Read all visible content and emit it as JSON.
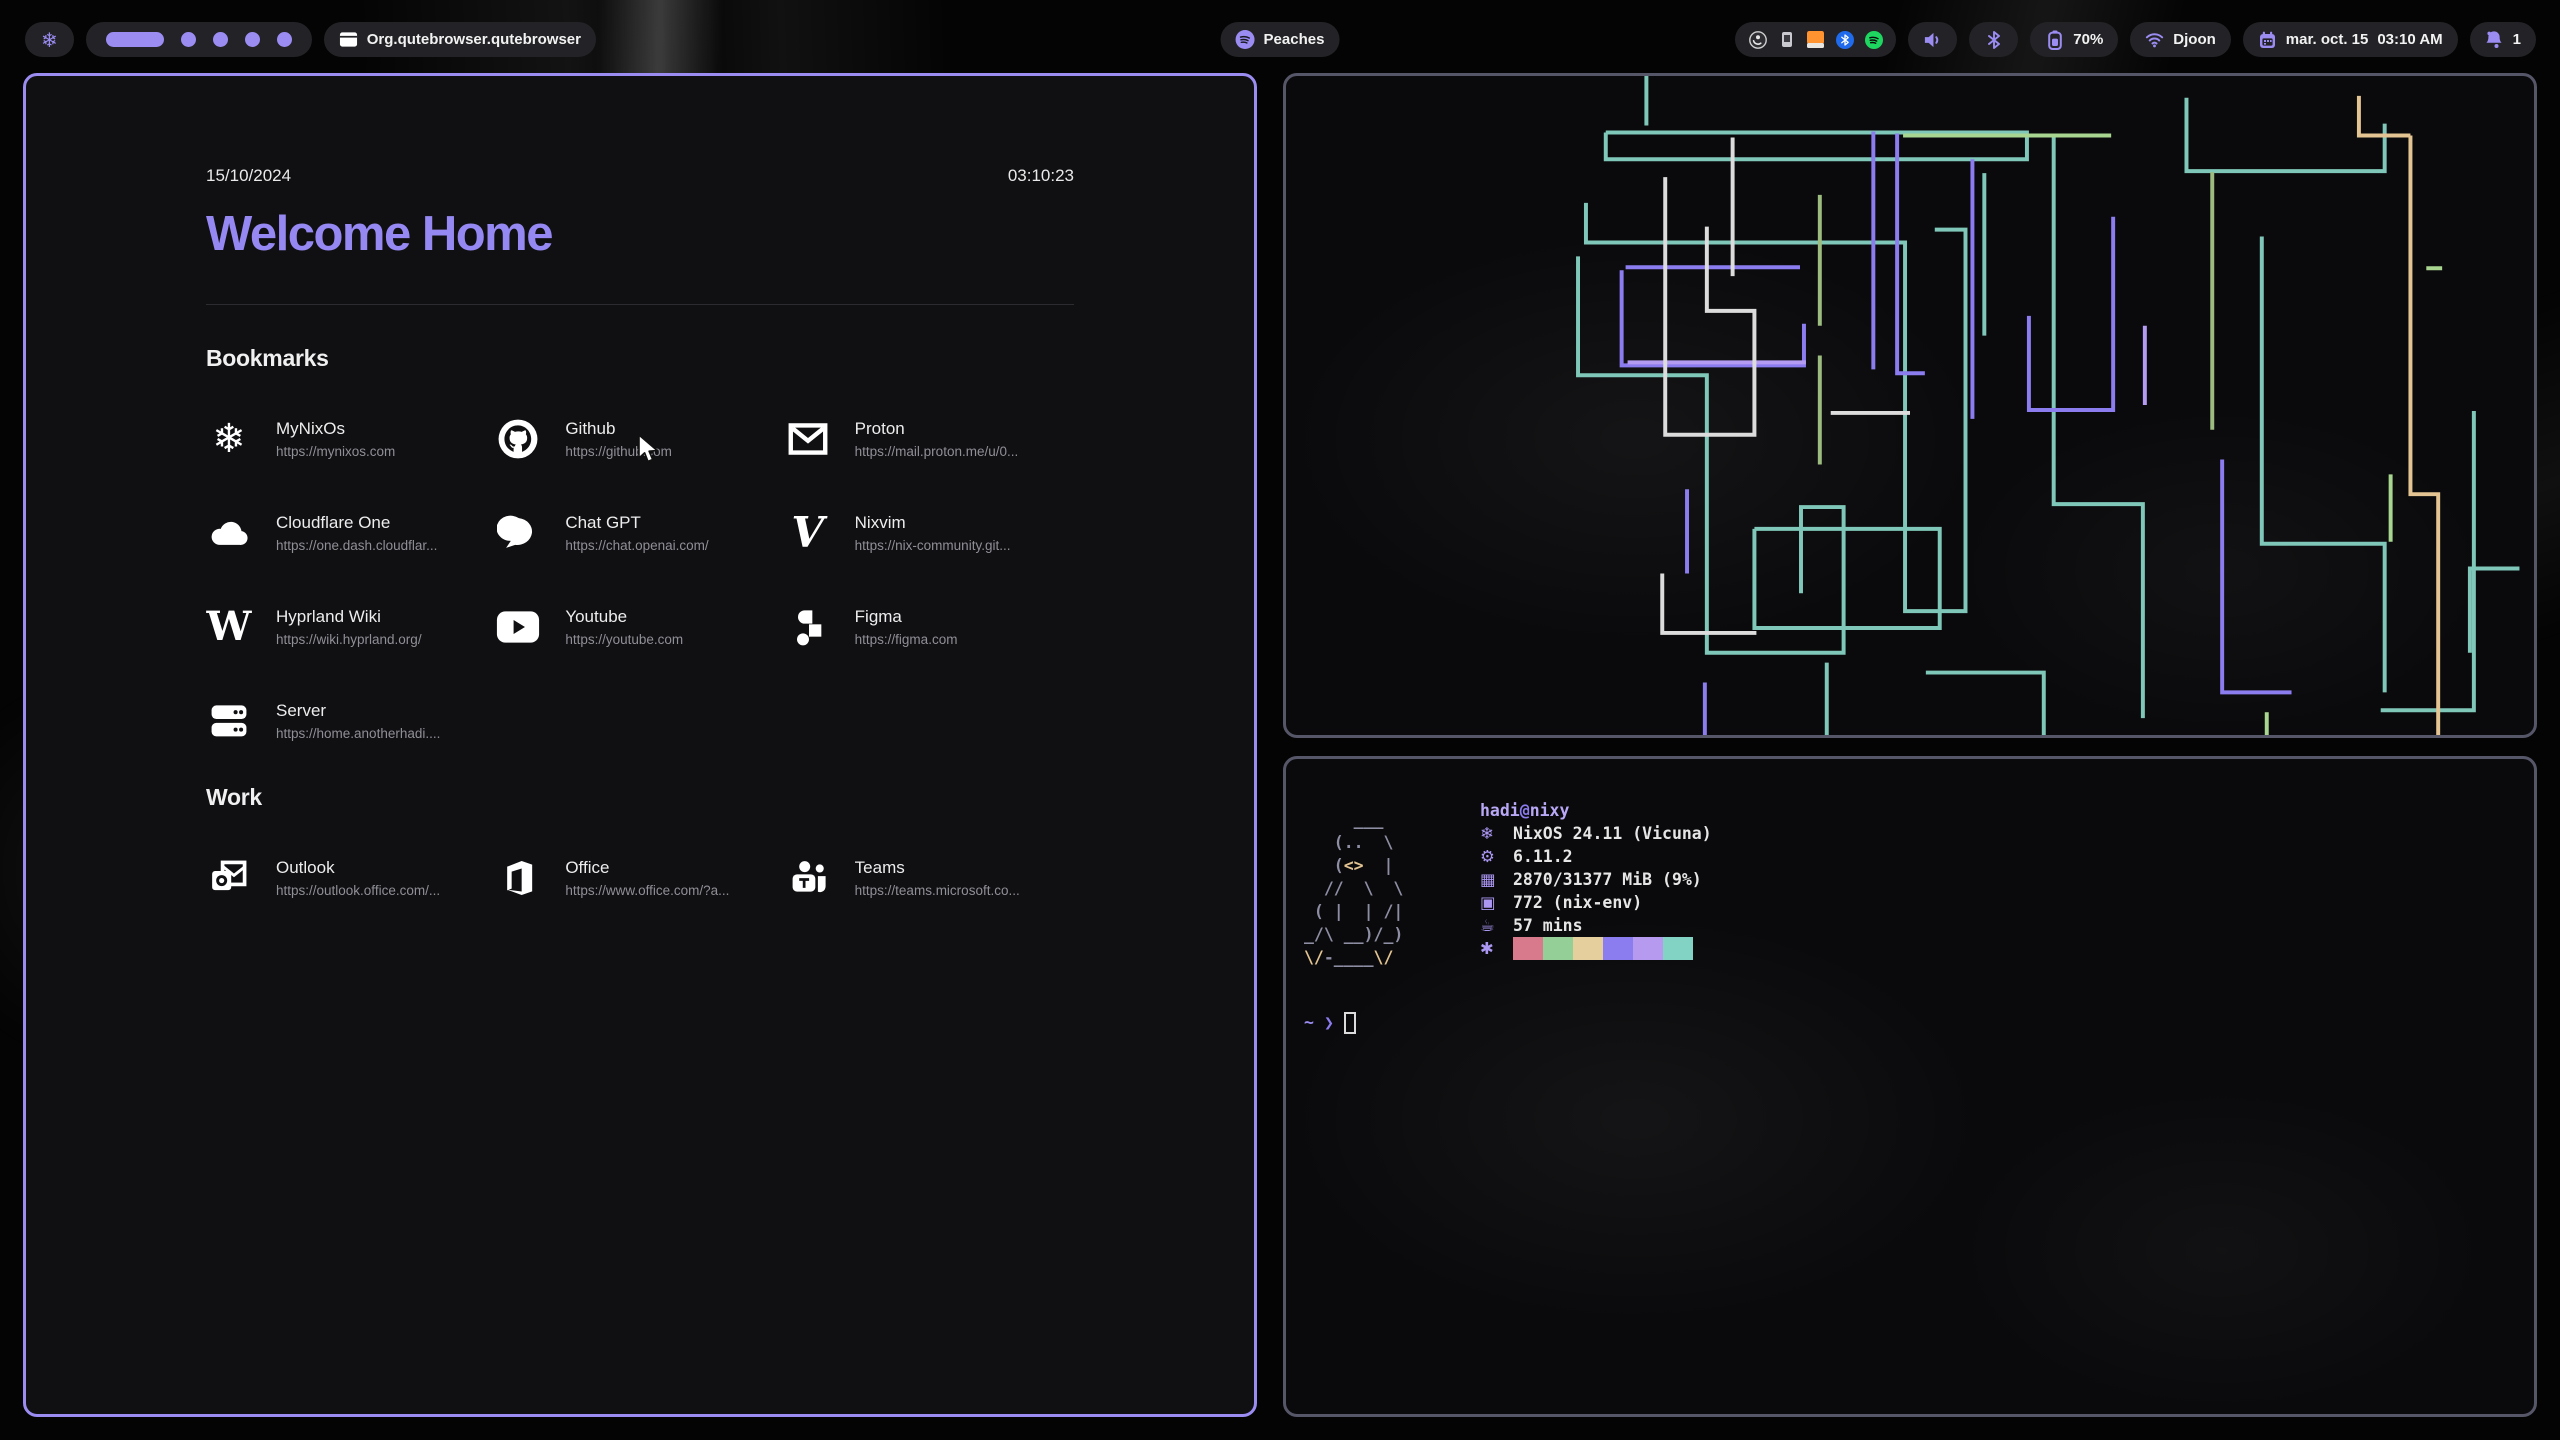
{
  "topbar": {
    "nix_glyph": "❄",
    "workspaces": {
      "count": 5,
      "active_index": 0
    },
    "window_title": "Org.qutebrowser.qutebrowser",
    "media": {
      "title": "Peaches"
    },
    "tray_icons": [
      "obs",
      "widget",
      "orange-app",
      "bluetooth",
      "spotify"
    ],
    "battery_percent": "70%",
    "network_name": "Djoon",
    "clock_date": "mar. oct. 15",
    "clock_time": "03:10 AM",
    "notification_count": "1"
  },
  "startpage": {
    "date": "15/10/2024",
    "time": "03:10:23",
    "title": "Welcome Home",
    "sections": [
      {
        "heading": "Bookmarks",
        "items": [
          {
            "name": "MyNixOs",
            "url": "https://mynixos.com",
            "icon": "nixos"
          },
          {
            "name": "Github",
            "url": "https://github.com",
            "icon": "github"
          },
          {
            "name": "Proton",
            "url": "https://mail.proton.me/u/0...",
            "icon": "mail"
          },
          {
            "name": "Cloudflare One",
            "url": "https://one.dash.cloudflar...",
            "icon": "cloud"
          },
          {
            "name": "Chat GPT",
            "url": "https://chat.openai.com/",
            "icon": "chat"
          },
          {
            "name": "Nixvim",
            "url": "https://nix-community.git...",
            "icon": "vim"
          },
          {
            "name": "Hyprland Wiki",
            "url": "https://wiki.hyprland.org/",
            "icon": "wikipedia"
          },
          {
            "name": "Youtube",
            "url": "https://youtube.com",
            "icon": "youtube"
          },
          {
            "name": "Figma",
            "url": "https://figma.com",
            "icon": "figma"
          },
          {
            "name": "Server",
            "url": "https://home.anotherhadi....",
            "icon": "server"
          }
        ]
      },
      {
        "heading": "Work",
        "items": [
          {
            "name": "Outlook",
            "url": "https://outlook.office.com/...",
            "icon": "outlook"
          },
          {
            "name": "Office",
            "url": "https://www.office.com/?a...",
            "icon": "office"
          },
          {
            "name": "Teams",
            "url": "https://teams.microsoft.co...",
            "icon": "teams"
          }
        ]
      }
    ]
  },
  "fetch_terminal": {
    "user": "hadi",
    "at": "@",
    "host": "nixy",
    "ascii_art": [
      "     ___",
      "   (..  \\",
      "   (<>  |",
      "  //  \\  \\",
      " ( |  | /|",
      "_/\\ __)/_)",
      "\\/-____\\/"
    ],
    "rows": [
      {
        "icon": "snowflake",
        "glyph": "❄",
        "text": "NixOS 24.11 (Vicuna)"
      },
      {
        "icon": "kernel",
        "glyph": "⚙",
        "text": "6.11.2"
      },
      {
        "icon": "memory",
        "glyph": "▦",
        "text": "2870/31377 MiB (9%)"
      },
      {
        "icon": "packages",
        "glyph": "▣",
        "text": "772 (nix-env)"
      },
      {
        "icon": "uptime",
        "glyph": "☕",
        "text": "57 mins"
      }
    ],
    "palette_icon_glyph": "✱",
    "palette": [
      "#d8798c",
      "#93cf97",
      "#e5cf9c",
      "#8b7cf0",
      "#b69af0",
      "#82d3c4"
    ],
    "prompt": {
      "tilde": "~",
      "chevron": "❯"
    }
  },
  "pipes_art": {
    "stroke_width": 4,
    "colors": {
      "teal": "#7fc7b8",
      "purple": "#8b7cf0",
      "lavender": "#b39cf2",
      "white": "#dcdcdc",
      "olive": "#9cbc80",
      "green": "#a8d58f",
      "tan": "#e3c492"
    },
    "lines": [
      {
        "c": "teal",
        "p": "361,0 361,50"
      },
      {
        "c": "teal",
        "p": "320,57 745,57 745,84 320,84 320,57"
      },
      {
        "c": "teal",
        "p": "300,128 300,168 622,168 622,540 683,540 683,155 652,155"
      },
      {
        "c": "teal",
        "p": "292,182 292,302 422,302 422,582 560,582 560,435 517,435 517,522"
      },
      {
        "c": "teal",
        "p": "702,98 702,262"
      },
      {
        "c": "teal",
        "p": "772,62 772,432 862,432 862,648"
      },
      {
        "c": "teal",
        "p": "906,22 906,96 1106,96 1106,48"
      },
      {
        "c": "teal",
        "p": "982,162 982,472 1106,472 1106,622"
      },
      {
        "c": "teal",
        "p": "1196,338 1196,640 1102,640"
      },
      {
        "c": "teal",
        "p": "470,457 657,457 657,557 470,557 470,457"
      },
      {
        "c": "teal",
        "p": "543,592 543,665"
      },
      {
        "c": "teal",
        "p": "643,602 762,602 762,665"
      },
      {
        "c": "teal",
        "p": "1242,497 1192,497 1192,582"
      },
      {
        "c": "purple",
        "p": "336,196 336,292 520,292 520,250"
      },
      {
        "c": "purple",
        "p": "340,193 516,193"
      },
      {
        "c": "purple",
        "p": "590,56 590,296"
      },
      {
        "c": "purple",
        "p": "614,58 614,300 642,300"
      },
      {
        "c": "purple",
        "p": "690,84 690,346"
      },
      {
        "c": "purple",
        "p": "747,242 747,337 832,337 832,142"
      },
      {
        "c": "purple",
        "p": "402,417 402,502"
      },
      {
        "c": "purple",
        "p": "420,612 420,665"
      },
      {
        "c": "purple",
        "p": "942,387 942,622 1012,622"
      },
      {
        "c": "lavender",
        "p": "342,289 522,289"
      },
      {
        "c": "lavender",
        "p": "864,252 864,332"
      },
      {
        "c": "white",
        "p": "380,102 380,362 470,362 470,237 422,237 422,152"
      },
      {
        "c": "white",
        "p": "448,62 448,202"
      },
      {
        "c": "white",
        "p": "547,340 627,340"
      },
      {
        "c": "white",
        "p": "377,502 377,562 472,562"
      },
      {
        "c": "olive",
        "p": "536,120 536,252"
      },
      {
        "c": "olive",
        "p": "536,282 536,392"
      },
      {
        "c": "olive",
        "p": "932,97 932,357"
      },
      {
        "c": "green",
        "p": "1148,194 1164,194"
      },
      {
        "c": "green",
        "p": "620,60 830,60"
      },
      {
        "c": "green",
        "p": "1112,402 1112,470"
      },
      {
        "c": "green",
        "p": "987,642 987,665"
      },
      {
        "c": "tan",
        "p": "1080,20 1080,60 1132,60"
      },
      {
        "c": "tan",
        "p": "1132,60 1132,422 1160,422 1160,665"
      }
    ]
  }
}
